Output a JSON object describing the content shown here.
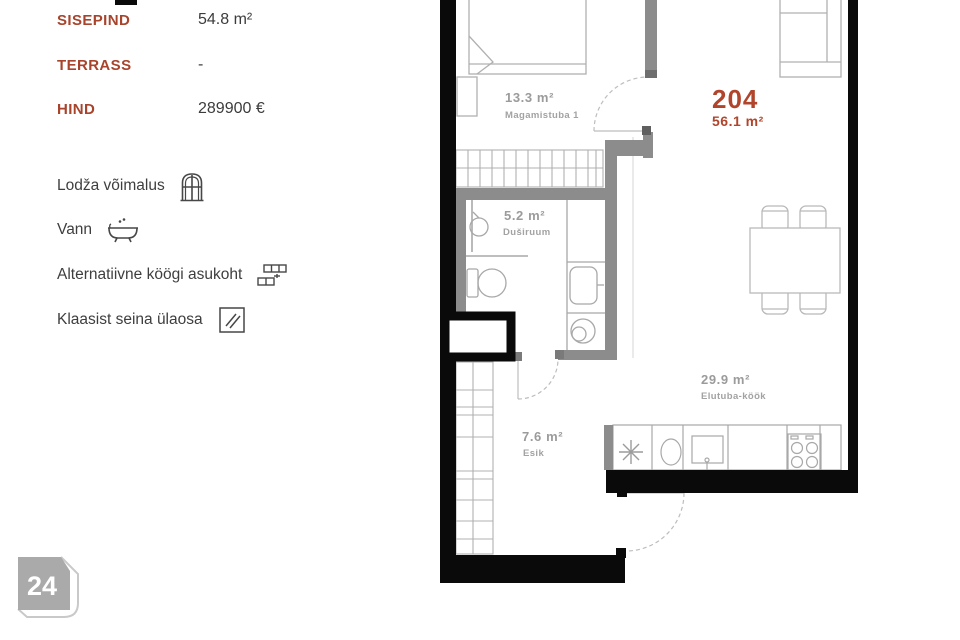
{
  "panel": {
    "specs": [
      {
        "label": "SISEPIND",
        "value": "54.8 m²"
      },
      {
        "label": "TERRASS",
        "value": "-"
      },
      {
        "label": "HIND",
        "value": "289900 €"
      }
    ],
    "features": [
      {
        "label": "Lodža võimalus",
        "icon": "arch-window-icon"
      },
      {
        "label": "Vann",
        "icon": "bathtub-icon"
      },
      {
        "label": "Alternatiivne köögi asukoht",
        "icon": "bricks-icon"
      },
      {
        "label": "Klaasist seina ülaosa",
        "icon": "glass-pane-icon"
      }
    ]
  },
  "floorplan": {
    "unit_number": "204",
    "unit_area": "56.1 m²",
    "rooms": [
      {
        "area": "13.3 m²",
        "name": "Magamistuba 1"
      },
      {
        "area": "5.2 m²",
        "name": "Duširuum"
      },
      {
        "area": "29.9 m²",
        "name": "Elutuba-köök"
      },
      {
        "area": "7.6 m²",
        "name": "Esik"
      }
    ]
  },
  "badge": {
    "number": "24"
  },
  "colors": {
    "accent_red": "#a8432c",
    "plan_red": "#b0452c",
    "wall_black": "#0a0a0a",
    "wall_gray": "#8c8c8c",
    "furniture_line": "#b0b0b0",
    "plan_text_gray": "#9b9b9b",
    "badge_gray": "#aaaaaa"
  }
}
